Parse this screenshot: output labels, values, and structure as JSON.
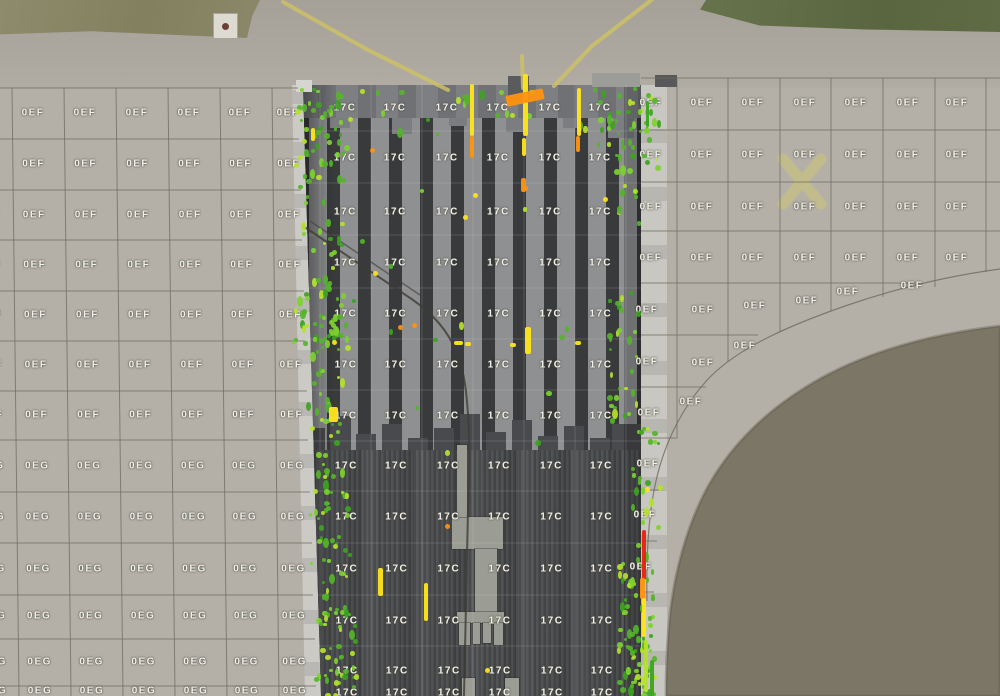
{
  "app": {
    "view_title": "Aerial pavement inspection map"
  },
  "zones": {
    "apron_upper_label": "0EF",
    "apron_lower_label": "0EG",
    "runway_label": "17C"
  },
  "colors": {
    "apron_pavement": "#b4b0a8",
    "top_pavement": "#a8a49b",
    "grid_line": "#6e6b5c",
    "label_text": "#f2f1ea",
    "runway_dark": "#434447",
    "runway_stripe_light": "#8f9092",
    "shoulder": "#c6c5bf",
    "grass_topleft": "#8c896b",
    "grass_topright": "#5e6b45",
    "grass_field": "#7b7666",
    "taxi_line_yellow": "#cdc166",
    "detect_yellow": "#ffe61c",
    "detect_orange": "#ff9410",
    "detect_red": "#e8220f",
    "detect_green": "#3da321",
    "detect_green_mid": "#55b42a",
    "detect_green_bright": "#7ed32f",
    "detect_lime": "#b5e22c"
  },
  "map": {
    "label_blocks": [
      {
        "label": "0EF",
        "cols": [
          -12,
          33,
          85,
          137,
          189,
          240,
          288
        ],
        "rows": [
          113,
          164,
          215,
          265,
          315,
          365,
          415
        ],
        "skew": 0.0121,
        "refY": 113
      },
      {
        "label": "0EG",
        "cols": [
          -12,
          33,
          85,
          137,
          189,
          240,
          288
        ],
        "rows": [
          466,
          517,
          569,
          616,
          662,
          691
        ],
        "skew": 0.0121,
        "refY": 113
      },
      {
        "label": "17C",
        "cols": [
          345,
          395,
          447,
          498,
          550,
          600
        ],
        "rows": [
          108,
          158,
          212,
          263,
          314,
          365,
          416,
          466,
          517,
          569,
          621,
          671,
          693
        ],
        "skew": 0.004,
        "refY": 108
      },
      {
        "label": "0EF",
        "cols": [
          651,
          702,
          753,
          805,
          856,
          908,
          957
        ],
        "rows": [
          103,
          155,
          207,
          258
        ],
        "skew": 0,
        "refY": 103
      },
      {
        "label": "0EF",
        "points": [
          [
            647,
            310
          ],
          [
            703,
            310
          ],
          [
            755,
            306
          ],
          [
            807,
            301
          ],
          [
            848,
            292
          ],
          [
            912,
            286
          ],
          [
            647,
            362
          ],
          [
            703,
            363
          ],
          [
            745,
            346
          ],
          [
            649,
            413
          ],
          [
            691,
            402
          ],
          [
            648,
            464
          ],
          [
            645,
            515
          ],
          [
            641,
            567
          ]
        ]
      }
    ],
    "gridlines": {
      "left_h": [
        [
          0,
          88,
          298,
          88
        ],
        [
          0,
          139,
          299,
          139
        ],
        [
          0,
          190,
          301,
          190
        ],
        [
          0,
          240,
          302,
          240
        ],
        [
          0,
          291,
          304,
          291
        ],
        [
          0,
          341,
          305,
          341
        ],
        [
          0,
          391,
          307,
          391
        ],
        [
          0,
          440,
          308,
          440
        ],
        [
          0,
          492,
          310,
          492
        ],
        [
          0,
          543,
          312,
          543
        ],
        [
          0,
          595,
          313,
          595
        ],
        [
          0,
          639,
          315,
          639
        ],
        [
          0,
          686,
          316,
          686
        ]
      ],
      "left_v": [
        [
          12,
          88,
          19,
          696
        ],
        [
          64,
          88,
          71,
          696
        ],
        [
          116,
          88,
          123,
          696
        ],
        [
          168,
          88,
          175,
          696
        ],
        [
          220,
          88,
          227,
          696
        ],
        [
          272,
          88,
          279,
          696
        ]
      ],
      "right_h": [
        [
          641,
          78,
          1000,
          78
        ],
        [
          641,
          130,
          1000,
          130
        ],
        [
          641,
          182,
          1000,
          182
        ],
        [
          641,
          231,
          1000,
          231
        ],
        [
          641,
          283,
          918,
          283
        ],
        [
          641,
          335,
          758,
          335
        ],
        [
          641,
          387,
          706,
          387
        ],
        [
          641,
          438,
          678,
          438
        ],
        [
          642,
          490,
          663,
          490
        ],
        [
          643,
          541,
          657,
          541
        ],
        [
          644,
          592,
          654,
          592
        ]
      ],
      "right_v": [
        [
          677,
          78,
          677,
          437
        ],
        [
          728,
          78,
          728,
          362
        ],
        [
          780,
          78,
          780,
          332
        ],
        [
          831,
          78,
          831,
          311
        ],
        [
          883,
          78,
          883,
          297
        ],
        [
          935,
          78,
          935,
          287
        ],
        [
          986,
          78,
          986,
          272
        ]
      ],
      "runway_v": [
        [
          320,
          85,
          320,
          696
        ],
        [
          371,
          85,
          371,
          696
        ],
        [
          422,
          85,
          422,
          696
        ],
        [
          473,
          85,
          473,
          696
        ],
        [
          524,
          85,
          524,
          696
        ],
        [
          575,
          85,
          575,
          696
        ],
        [
          626,
          85,
          626,
          696
        ]
      ],
      "runway_h": [
        [
          306,
          131,
          641,
          131
        ],
        [
          306,
          183,
          641,
          183
        ],
        [
          306,
          235,
          641,
          235
        ],
        [
          306,
          288,
          641,
          288
        ],
        [
          306,
          339,
          641,
          339
        ],
        [
          306,
          390,
          641,
          390
        ],
        [
          306,
          441,
          641,
          441
        ],
        [
          308,
          491,
          641,
          491
        ],
        [
          310,
          543,
          641,
          543
        ],
        [
          312,
          595,
          641,
          595
        ],
        [
          314,
          646,
          641,
          646
        ]
      ]
    },
    "paths": {
      "grass_field": "M1000,326 C930,334 860,353 806,387 C762,414 727,450 705,492 C687,527 675,570 670,614 C667,644 666,672 666,696 L1000,696 Z",
      "curve_boundary": "M1000,269 C948,276 897,288 845,306 C791,325 741,346 710,377 C684,404 665,441 656,481 C649,512 646,552 647,601",
      "taxi_left": "M283,2 L368,50 L448,90",
      "taxi_right": "M654,-2 L592,46 L554,86",
      "taxi_center": "M522,56 L523,88",
      "closed_x_mark": "M783,159 L821,204 M821,159 L783,204",
      "crack_main": "M303,226 L413,300 C449,325 462,355 466,392 C471,436 469,470 468,510 L464,696",
      "crack_parallel": "M310,221 L420,295"
    },
    "runway_geometry": {
      "clip": "polygon(303px 85px, 641px 85px, 641px 696px, 321px 696px)",
      "threshold_band": [
        85,
        122
      ],
      "stripe_zone": [
        118,
        452
      ],
      "lower_zone": [
        450,
        696
      ],
      "stagger_top": [
        [
          330,
          118,
          20,
          10
        ],
        [
          392,
          118,
          20,
          16
        ],
        [
          449,
          118,
          18,
          8
        ],
        [
          506,
          118,
          20,
          14
        ],
        [
          563,
          118,
          18,
          10
        ],
        [
          608,
          118,
          26,
          20
        ]
      ],
      "stagger_bottom": [
        [
          303,
          428,
          22,
          24
        ],
        [
          330,
          416,
          21,
          36
        ],
        [
          356,
          434,
          20,
          18
        ],
        [
          382,
          424,
          20,
          28
        ],
        [
          408,
          438,
          20,
          14
        ],
        [
          434,
          428,
          20,
          24
        ],
        [
          460,
          414,
          20,
          38
        ],
        [
          486,
          432,
          20,
          20
        ],
        [
          512,
          420,
          20,
          32
        ],
        [
          538,
          436,
          20,
          16
        ],
        [
          564,
          426,
          20,
          26
        ],
        [
          590,
          438,
          20,
          14
        ],
        [
          612,
          424,
          29,
          28
        ]
      ],
      "center_mark_blocks": [
        [
          452,
          517,
          51,
          32
        ],
        [
          475,
          549,
          22,
          64
        ],
        [
          457,
          612,
          47,
          11
        ],
        [
          459,
          623,
          11,
          22
        ],
        [
          473,
          623,
          7,
          21
        ],
        [
          483,
          623,
          8,
          20
        ],
        [
          494,
          623,
          9,
          22
        ],
        [
          462,
          678,
          13,
          18
        ],
        [
          505,
          678,
          14,
          18
        ],
        [
          457,
          445,
          10,
          72
        ]
      ],
      "edge_blocks": [
        [
          592,
          73,
          48,
          14,
          "#9c9c99"
        ],
        [
          655,
          75,
          22,
          12,
          "#58585a"
        ],
        [
          508,
          76,
          21,
          26,
          "#5a5b5d"
        ],
        [
          296,
          80,
          16,
          12,
          "#d6d5d0"
        ]
      ]
    },
    "detections": {
      "streaks": [
        [
          470,
          84,
          4,
          52,
          "y",
          0
        ],
        [
          470,
          136,
          4,
          22,
          "o",
          0
        ],
        [
          523,
          74,
          5,
          62,
          "y",
          0
        ],
        [
          522,
          138,
          4,
          18,
          "y",
          0
        ],
        [
          521,
          178,
          5,
          14,
          "o",
          0
        ],
        [
          577,
          88,
          4,
          48,
          "y",
          0
        ],
        [
          576,
          136,
          4,
          16,
          "o",
          0
        ],
        [
          506,
          92,
          38,
          11,
          "o",
          -12
        ],
        [
          525,
          327,
          6,
          27,
          "y",
          0
        ],
        [
          454,
          341,
          9,
          4,
          "y",
          0
        ],
        [
          465,
          342,
          6,
          4,
          "y",
          0
        ],
        [
          510,
          343,
          6,
          4,
          "y",
          0
        ],
        [
          575,
          341,
          6,
          4,
          "y",
          0
        ],
        [
          378,
          568,
          5,
          28,
          "y",
          0
        ],
        [
          424,
          583,
          4,
          38,
          "y",
          0
        ],
        [
          311,
          128,
          4,
          13,
          "y",
          0
        ],
        [
          329,
          407,
          9,
          15,
          "y",
          0
        ],
        [
          642,
          530,
          4,
          50,
          "r",
          0
        ],
        [
          640,
          578,
          5,
          21,
          "o",
          0
        ],
        [
          642,
          598,
          4,
          39,
          "y",
          0
        ],
        [
          644,
          640,
          4,
          52,
          "lg",
          0
        ],
        [
          650,
          660,
          4,
          36,
          "g",
          0
        ],
        [
          646,
          101,
          3,
          26,
          "g",
          0
        ]
      ],
      "single_dots": {
        "y": [
          [
            473,
            193
          ],
          [
            463,
            215
          ],
          [
            485,
            668
          ],
          [
            645,
            487
          ],
          [
            603,
            197
          ],
          [
            332,
            340
          ],
          [
            373,
            271
          ]
        ],
        "o": [
          [
            370,
            148
          ],
          [
            412,
            323
          ],
          [
            523,
            186
          ],
          [
            445,
            524
          ],
          [
            398,
            325
          ]
        ]
      },
      "clusters": [
        {
          "x": 294,
          "y": 86,
          "w": 50,
          "h": 105,
          "n": 48
        },
        {
          "x": 300,
          "y": 195,
          "w": 42,
          "h": 100,
          "n": 26
        },
        {
          "x": 292,
          "y": 288,
          "w": 54,
          "h": 58,
          "n": 42
        },
        {
          "x": 304,
          "y": 348,
          "w": 36,
          "h": 118,
          "n": 26
        },
        {
          "x": 308,
          "y": 466,
          "w": 40,
          "h": 120,
          "n": 42
        },
        {
          "x": 314,
          "y": 586,
          "w": 40,
          "h": 110,
          "n": 48
        },
        {
          "x": 596,
          "y": 86,
          "w": 50,
          "h": 72,
          "n": 36
        },
        {
          "x": 612,
          "y": 158,
          "w": 28,
          "h": 66,
          "n": 12
        },
        {
          "x": 606,
          "y": 288,
          "w": 32,
          "h": 132,
          "n": 30
        },
        {
          "x": 630,
          "y": 424,
          "w": 28,
          "h": 102,
          "n": 22
        },
        {
          "x": 616,
          "y": 542,
          "w": 36,
          "h": 154,
          "n": 58
        },
        {
          "x": 336,
          "y": 88,
          "w": 266,
          "h": 46,
          "n": 22
        },
        {
          "x": 332,
          "y": 142,
          "w": 286,
          "h": 320,
          "n": 15
        },
        {
          "x": 645,
          "y": 86,
          "w": 14,
          "h": 92,
          "n": 10
        },
        {
          "x": 628,
          "y": 630,
          "w": 24,
          "h": 66,
          "n": 26
        }
      ],
      "seed": 42
    }
  }
}
